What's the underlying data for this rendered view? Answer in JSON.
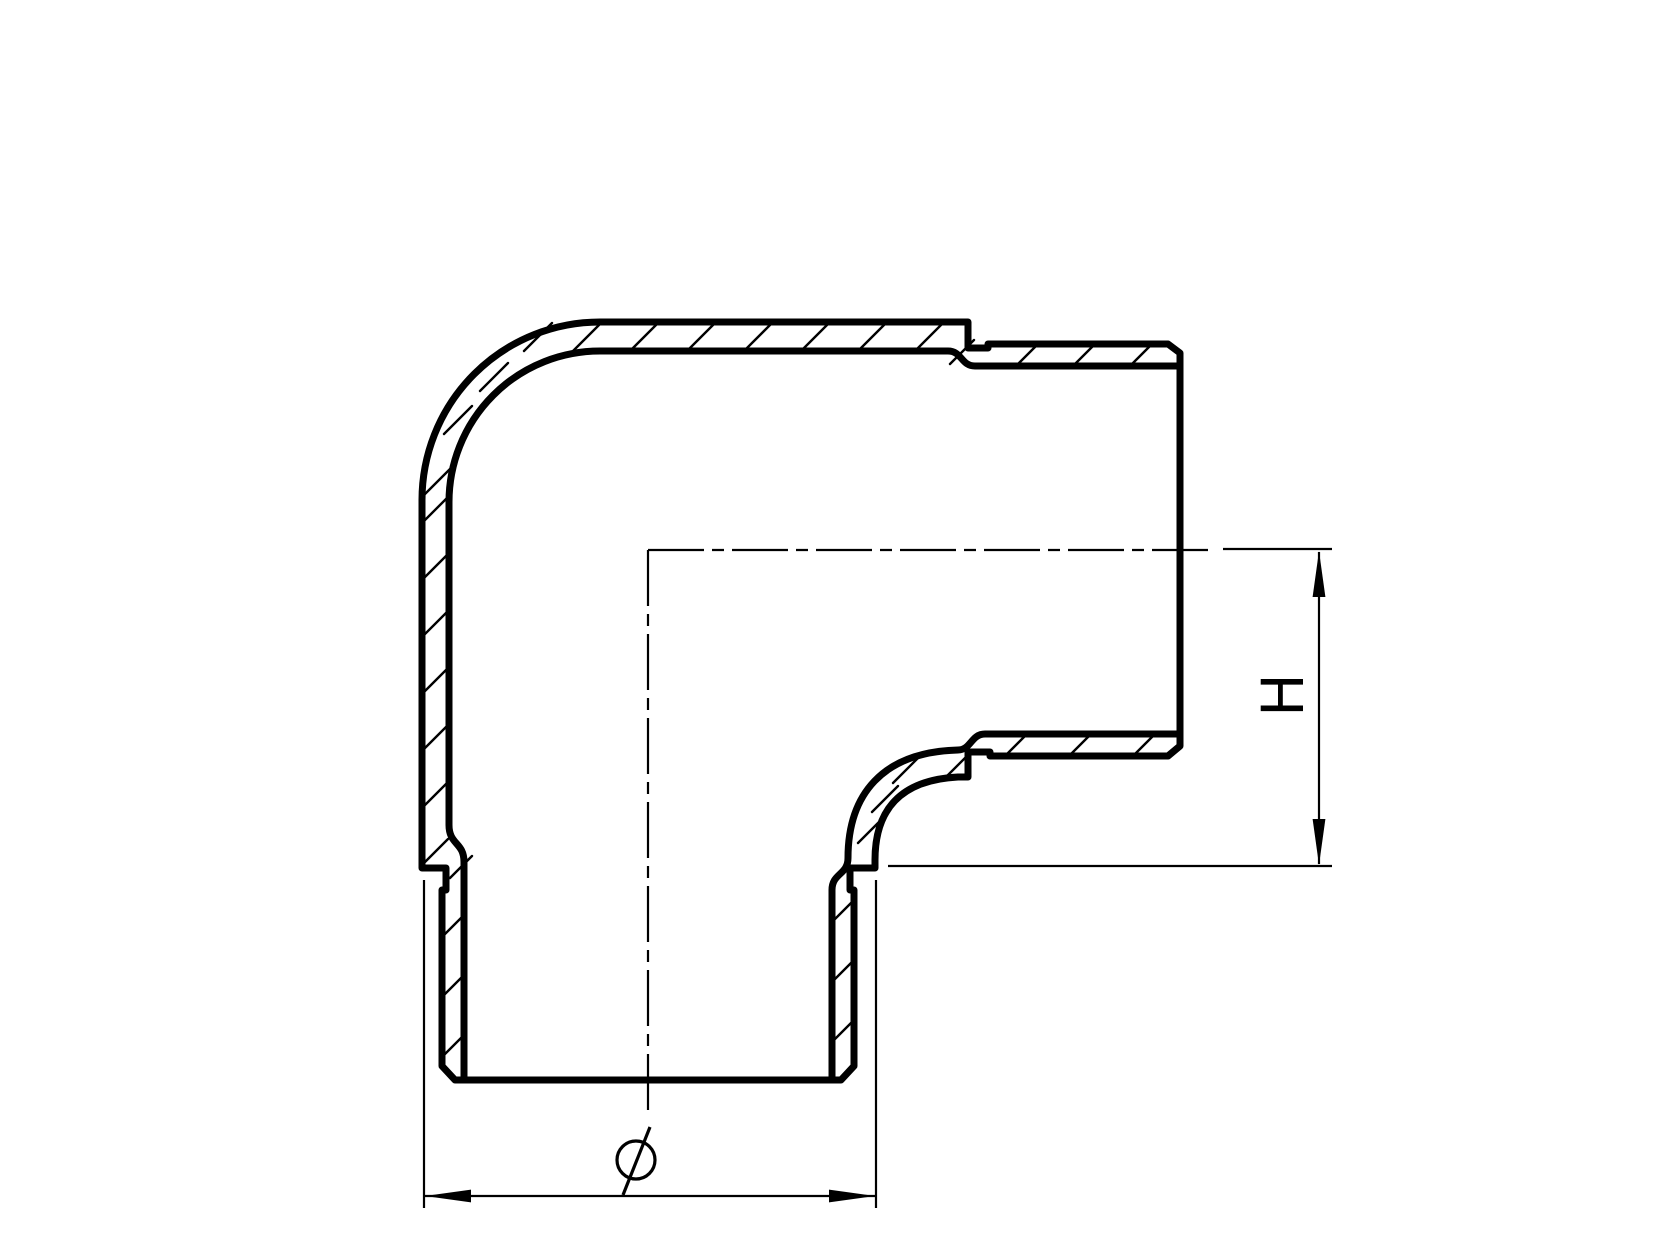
{
  "page": {
    "background": "#ffffff",
    "ink": "#000000",
    "description": "Sectional technical drawing of a 90-degree elbow tube fitting with spigot ends"
  },
  "drawing": {
    "outline": "M 600 322 L 968 322 L 968 348 L 988 348 L 988 344 L 1168 344 L 1180 353 L 1180 746 L 1168 756 L 990 756 L 990 752 L 968 752 L 968 777 L 958 777 C 900 780 875 810 875 860 L 875 868 L 850 868 L 850 890 L 854 890 L 854 1066 L 841 1080 L 455 1080 L 442 1066 L 442 890 L 446 890 L 446 868 L 422 868 L 422 500 A 178 178 0 0 1 600 322 Z",
    "bore_top": "M 1180 366 L 975 366 C 961 366 962 351 948 351 L 600 351 A 151 151 0 0 0 449 502 L 449 825 C 449 845 464 842 464 862 L 464 1080",
    "bore_right": "M 832 1080 L 832 890 C 832 873 848 875 848 858 C 848 795 882 752 958 750 C 971 750 971 734 985 734 L 1180 734",
    "centerlines": "M 648 550 L 1210 550 M 648 550 L 648 1110",
    "hatch": "M 573 351 L 602 322 M 630 351 L 659 322 M 687 351 L 716 322 M 744 351 L 773 322 M 801 351 L 830 322 M 858 351 L 887 322 M 915 351 L 944 322 M 950 364 L 974 340 M 1016 366 L 1038 344 M 1073 366 L 1095 344 M 1130 366 L 1152 344 M 947 776 L 973 750 M 1005 756 L 1027 734 M 1069 756 L 1091 734 M 1133 756 L 1155 734 M 858 843 L 882 819 M 872 812 L 898 786 M 893 783 L 918 758 M 832 922 L 854 900 M 832 982 L 854 960 M 832 1042 L 854 1020 M 422 523 L 448 497 M 422 580 L 448 554 M 422 637 L 448 611 M 422 694 L 448 668 M 422 751 L 448 725 M 422 808 L 448 782 M 422 865 L 448 839 M 450 878 L 472 856 M 442 937 L 464 915 M 442 997 L 464 975 M 442 1057 L 464 1035 M 524 351 L 552 323 M 480 391 L 508 363 M 444 434 L 472 406 M 424 495 L 450 469",
    "dimensions": {
      "height": {
        "label": "H",
        "line": "M 1319 552 L 1319 864",
        "extension_lines": "M 1223 549 L 1332 549 M 888 866 L 1332 866",
        "arrow_up_points": "1319,551 1312.6,597 1325.4,597",
        "arrow_down_points": "1319,865 1312.6,819 1325.4,819"
      },
      "diameter": {
        "label": "Ø",
        "line": "M 424 1196 L 876 1196",
        "extension_lines": "M 424 880 L 424 1208 M 876 880 L 876 1208",
        "arrow_left_points": "425,1196 471,1189.6 471,1202.4",
        "arrow_right_points": "875,1196 829,1189.6 829,1202.4",
        "symbol_slash": "M 623 1195 L 650 1127"
      }
    }
  }
}
